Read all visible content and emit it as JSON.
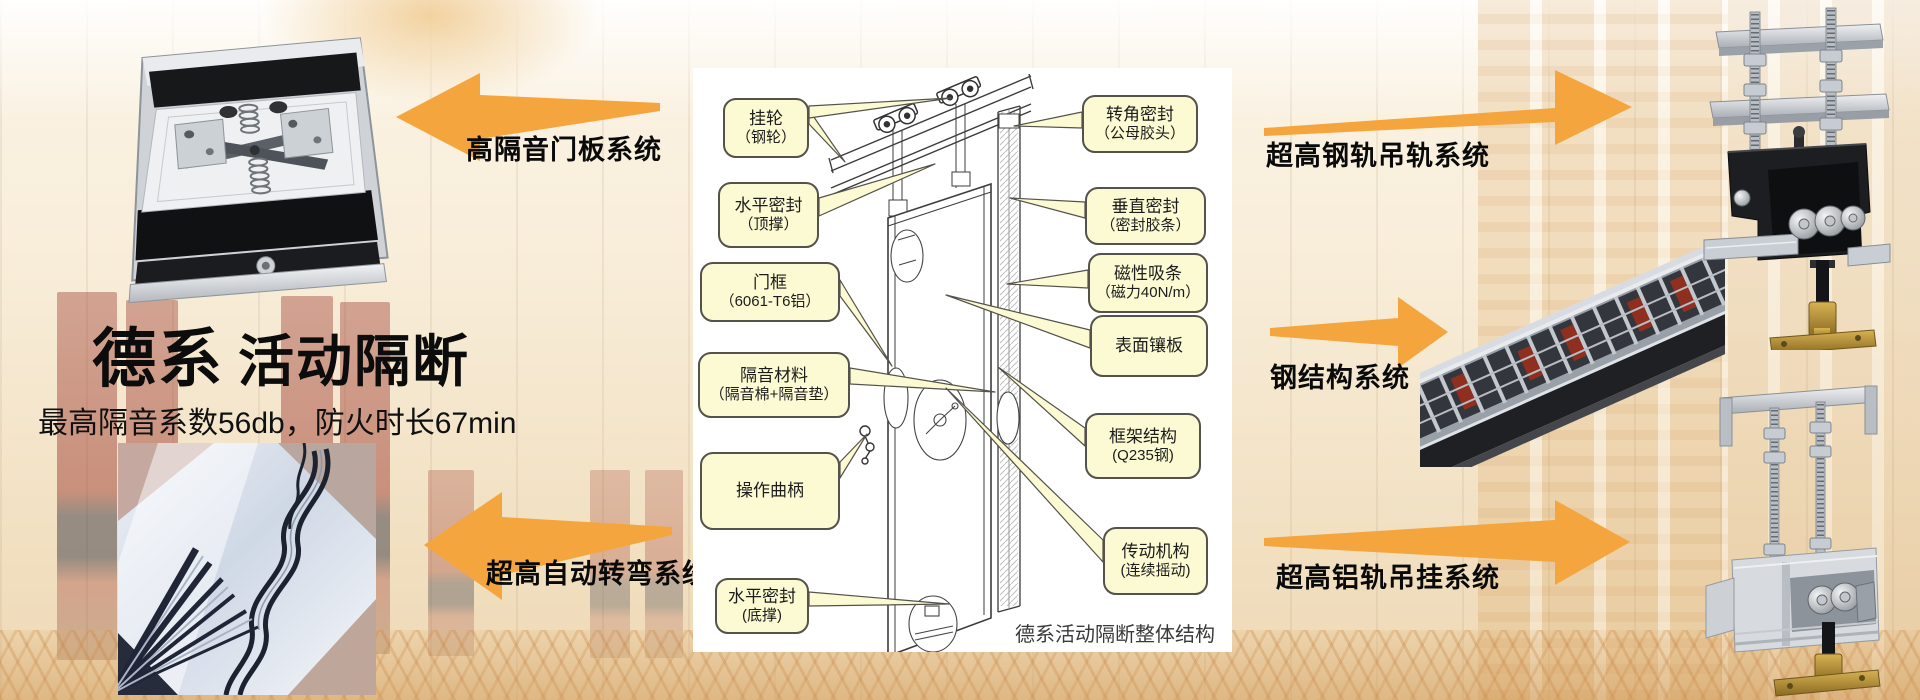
{
  "slide": {
    "title_brand": "德系",
    "title_rest": "活动隔断",
    "subtitle": "最高隔音系数56db，防火时长67min"
  },
  "system_labels": {
    "door_panel": "高隔音门板系统",
    "auto_turn": "超高自动转弯系统",
    "steel_rail_top": "超高钢轨吊轨系统",
    "steel_structure": "钢结构系统",
    "alu_rail_bottom": "超高铝轨吊挂系统"
  },
  "diagram": {
    "caption": "德系活动隔断整体结构",
    "callouts_left": [
      {
        "line1": "挂轮",
        "line2": "（钢轮）"
      },
      {
        "line1": "水平密封",
        "line2": "（顶撑）"
      },
      {
        "line1": "门框",
        "line2": "（6061-T6铝）"
      },
      {
        "line1": "隔音材料",
        "line2": "（隔音棉+隔音垫）"
      },
      {
        "line1": "操作曲柄",
        "line2": ""
      },
      {
        "line1": "水平密封",
        "line2": "(底撑)"
      }
    ],
    "callouts_right": [
      {
        "line1": "转角密封",
        "line2": "（公母胶头）"
      },
      {
        "line1": "垂直密封",
        "line2": "（密封胶条）"
      },
      {
        "line1": "磁性吸条",
        "line2": "（磁力40N/m）"
      },
      {
        "line1": "表面镶板",
        "line2": ""
      },
      {
        "line1": "框架结构",
        "line2": "(Q235钢)"
      },
      {
        "line1": "传动机构",
        "line2": "(连续摇动)"
      }
    ]
  },
  "colors": {
    "arrow": "#F5A53D",
    "callout_bg": "#FBFAD3",
    "callout_border": "#54524A",
    "title_text": "#111111"
  }
}
